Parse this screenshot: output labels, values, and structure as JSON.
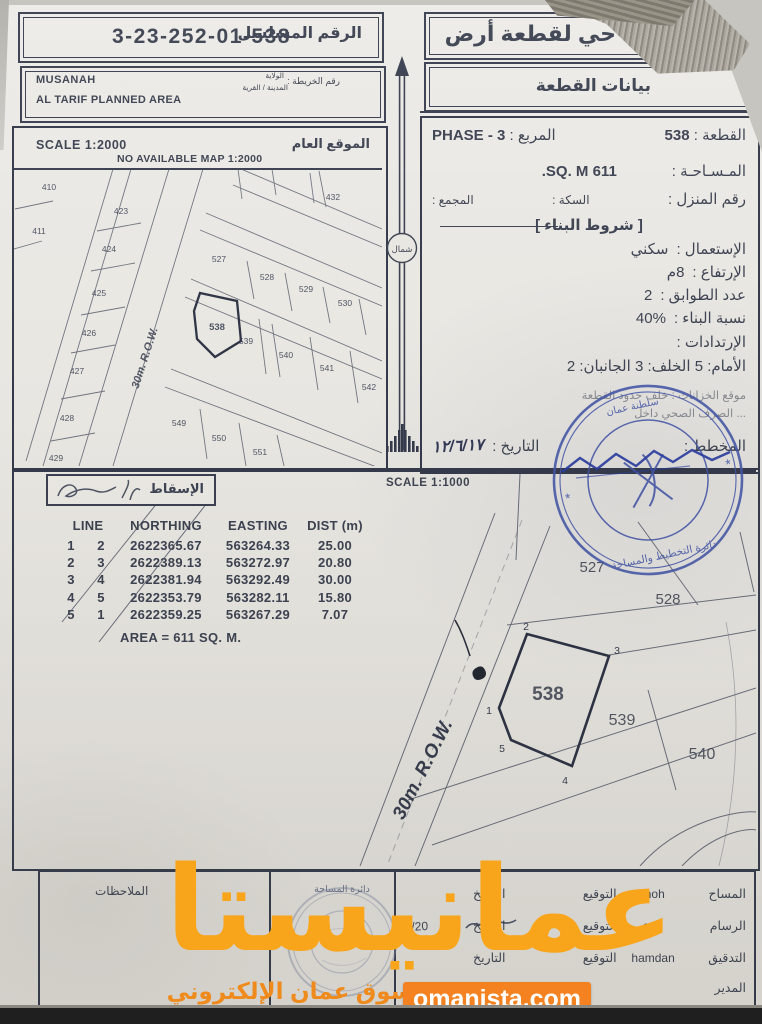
{
  "document": {
    "serial": {
      "label": "الرقم المسلسل",
      "value": "3-23-252-01-538"
    },
    "region": {
      "map_no_label": "رقم الخريطة :",
      "wilaya_label": "الولاية",
      "town_label": "المدينة / القرية",
      "wilaya": "MUSANAH",
      "planned_area": "AL TARIF PLANNED AREA"
    },
    "title_main": "حي لقطعة أرض",
    "title_sub": "بيانات القطعة"
  },
  "plot_info": {
    "plot_label": "القطعة :",
    "plot_value": "538",
    "square_label": "المربع :",
    "square_value": "PHASE - 3",
    "area_label": "المـسـاحـة :",
    "area_value": "611 SQ. M.",
    "house_label": "رقم المنزل :",
    "street_label": "السكة :",
    "complex_label": "المجمع :",
    "conditions_title": "[ شروط البناء ]",
    "use_label": "الإستعمال :",
    "use_value": "سكني",
    "height_label": "الإرتفاع :",
    "height_value": "8م",
    "floors_label": "عدد الطوابق :",
    "floors_value": "2",
    "ratio_label": "نسبة البناء :",
    "ratio_value": "40%",
    "setbacks_label": "الإرتدادات :",
    "setbacks_value": "الأمام: 5   الخلف: 3   الجانبان: 2",
    "tanks_note": "موقع الخزانات : خلف حدود القطعة",
    "sewage_note": "... الصرف الصحي داخل",
    "planner_label": "المخطط :",
    "date_label": "التاريخ :",
    "date_value": "١٢/٦/١٧"
  },
  "upper_map": {
    "scale": "SCALE 1:2000",
    "no_map": "NO AVAILABLE MAP 1:2000",
    "title": "الموقع العام",
    "road": "30m. R.O.W.",
    "north": "شمال",
    "plot_labels": [
      "410",
      "411",
      "423",
      "424",
      "425",
      "426",
      "427",
      "428",
      "429",
      "432",
      "527",
      "528",
      "529",
      "530",
      "538",
      "539",
      "540",
      "541",
      "542",
      "549",
      "550",
      "551"
    ]
  },
  "lower_map": {
    "scale": "SCALE 1:1000",
    "road": "30m. R.O.W.",
    "projection_label": "الإسقاط",
    "plot_labels": [
      "527",
      "528",
      "538",
      "539",
      "540"
    ],
    "vertex_labels": [
      "1",
      "2",
      "3",
      "4",
      "5"
    ]
  },
  "coords_table": {
    "headers": {
      "line": "LINE",
      "northing": "NORTHING",
      "easting": "EASTING",
      "dist": "DIST (m)"
    },
    "rows": [
      [
        "1",
        "2",
        "2622365.67",
        "563264.33",
        "25.00"
      ],
      [
        "2",
        "3",
        "2622389.13",
        "563272.97",
        "20.80"
      ],
      [
        "3",
        "4",
        "2622381.94",
        "563292.49",
        "30.00"
      ],
      [
        "4",
        "5",
        "2622353.79",
        "563282.11",
        "15.80"
      ],
      [
        "5",
        "1",
        "2622359.25",
        "563267.29",
        "7.07"
      ]
    ],
    "area": "AREA = 611 SQ. M."
  },
  "stamps": {
    "planning_top": "سلطنة عمان",
    "planning_bottom": "دائرة التخطيط والمساحة",
    "survey_top": "دائرة المساحة"
  },
  "footer": {
    "notes_label": "الملاحظات",
    "sign_rows": [
      {
        "role": "المساح",
        "name": "moh",
        "sig": "التوقيع",
        "date": "التاريخ",
        "date_value": ""
      },
      {
        "role": "الرسام",
        "name": "gad",
        "sig": "التوقيع",
        "date": "التاريخ",
        "date_value": "05/20"
      },
      {
        "role": "التدقيق",
        "name": "hamdan",
        "sig": "التوقيع",
        "date": "التاريخ",
        "date_value": ""
      },
      {
        "role": "المدير",
        "name": "",
        "sig": "",
        "date": "التاريخ",
        "date_value": ""
      }
    ]
  },
  "watermark": {
    "brand": "عمانيستا",
    "tagline": "سوق عمان الإلكتروني",
    "site": "omanista.com",
    "orange": "#F9A51B",
    "box_orange": "#F58220"
  },
  "colors": {
    "ink": "#3d4352",
    "stamp_blue": "#4355a5"
  }
}
